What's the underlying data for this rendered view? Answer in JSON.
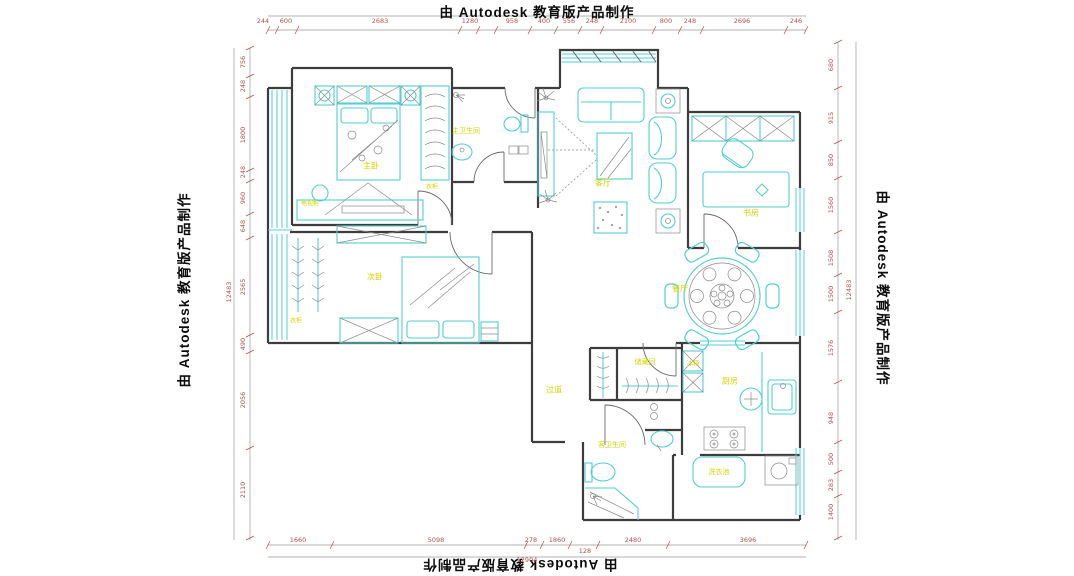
{
  "watermark": {
    "text": "由 Autodesk 教育版产品制作"
  },
  "colors": {
    "wall": "#3d3d3d",
    "furniture": "#52cfcf",
    "dimension_text": "#b05252",
    "room_label": "#d4d400",
    "watermark_text": "#0c0c0c"
  },
  "dimensions": {
    "top": [
      "244",
      "600",
      "2683",
      "1280",
      "958",
      "400",
      "556",
      "248",
      "2100",
      "800",
      "248",
      "2696",
      "246"
    ],
    "bottom": [
      "1660",
      "5098",
      "278",
      "1860",
      "128",
      "2480",
      "3696"
    ],
    "bottom_total": "12904",
    "left": [
      "756",
      "248",
      "1800",
      "248",
      "960",
      "648",
      "2565",
      "490",
      "2056",
      "2110"
    ],
    "left_total": "12483",
    "right": [
      "680",
      "915",
      "850",
      "1560",
      "1508",
      "1500",
      "1576",
      "948",
      "500",
      "283",
      "1400"
    ],
    "right_total": "12483"
  },
  "rooms": {
    "master_bedroom": "主卧",
    "master_bath": "主卫生间",
    "wardrobe_master": "衣柜",
    "tv_cabinet": "电视柜",
    "second_bedroom": "次卧",
    "wardrobe_second": "衣柜",
    "living_room": "客厅",
    "study": "书房",
    "dining_room": "餐厅",
    "storage_room": "储藏间",
    "fridge": "冰箱",
    "kitchen": "厨房",
    "hallway": "过道",
    "guest_bath": "客卫生间",
    "laundry_sink": "洗衣池"
  }
}
